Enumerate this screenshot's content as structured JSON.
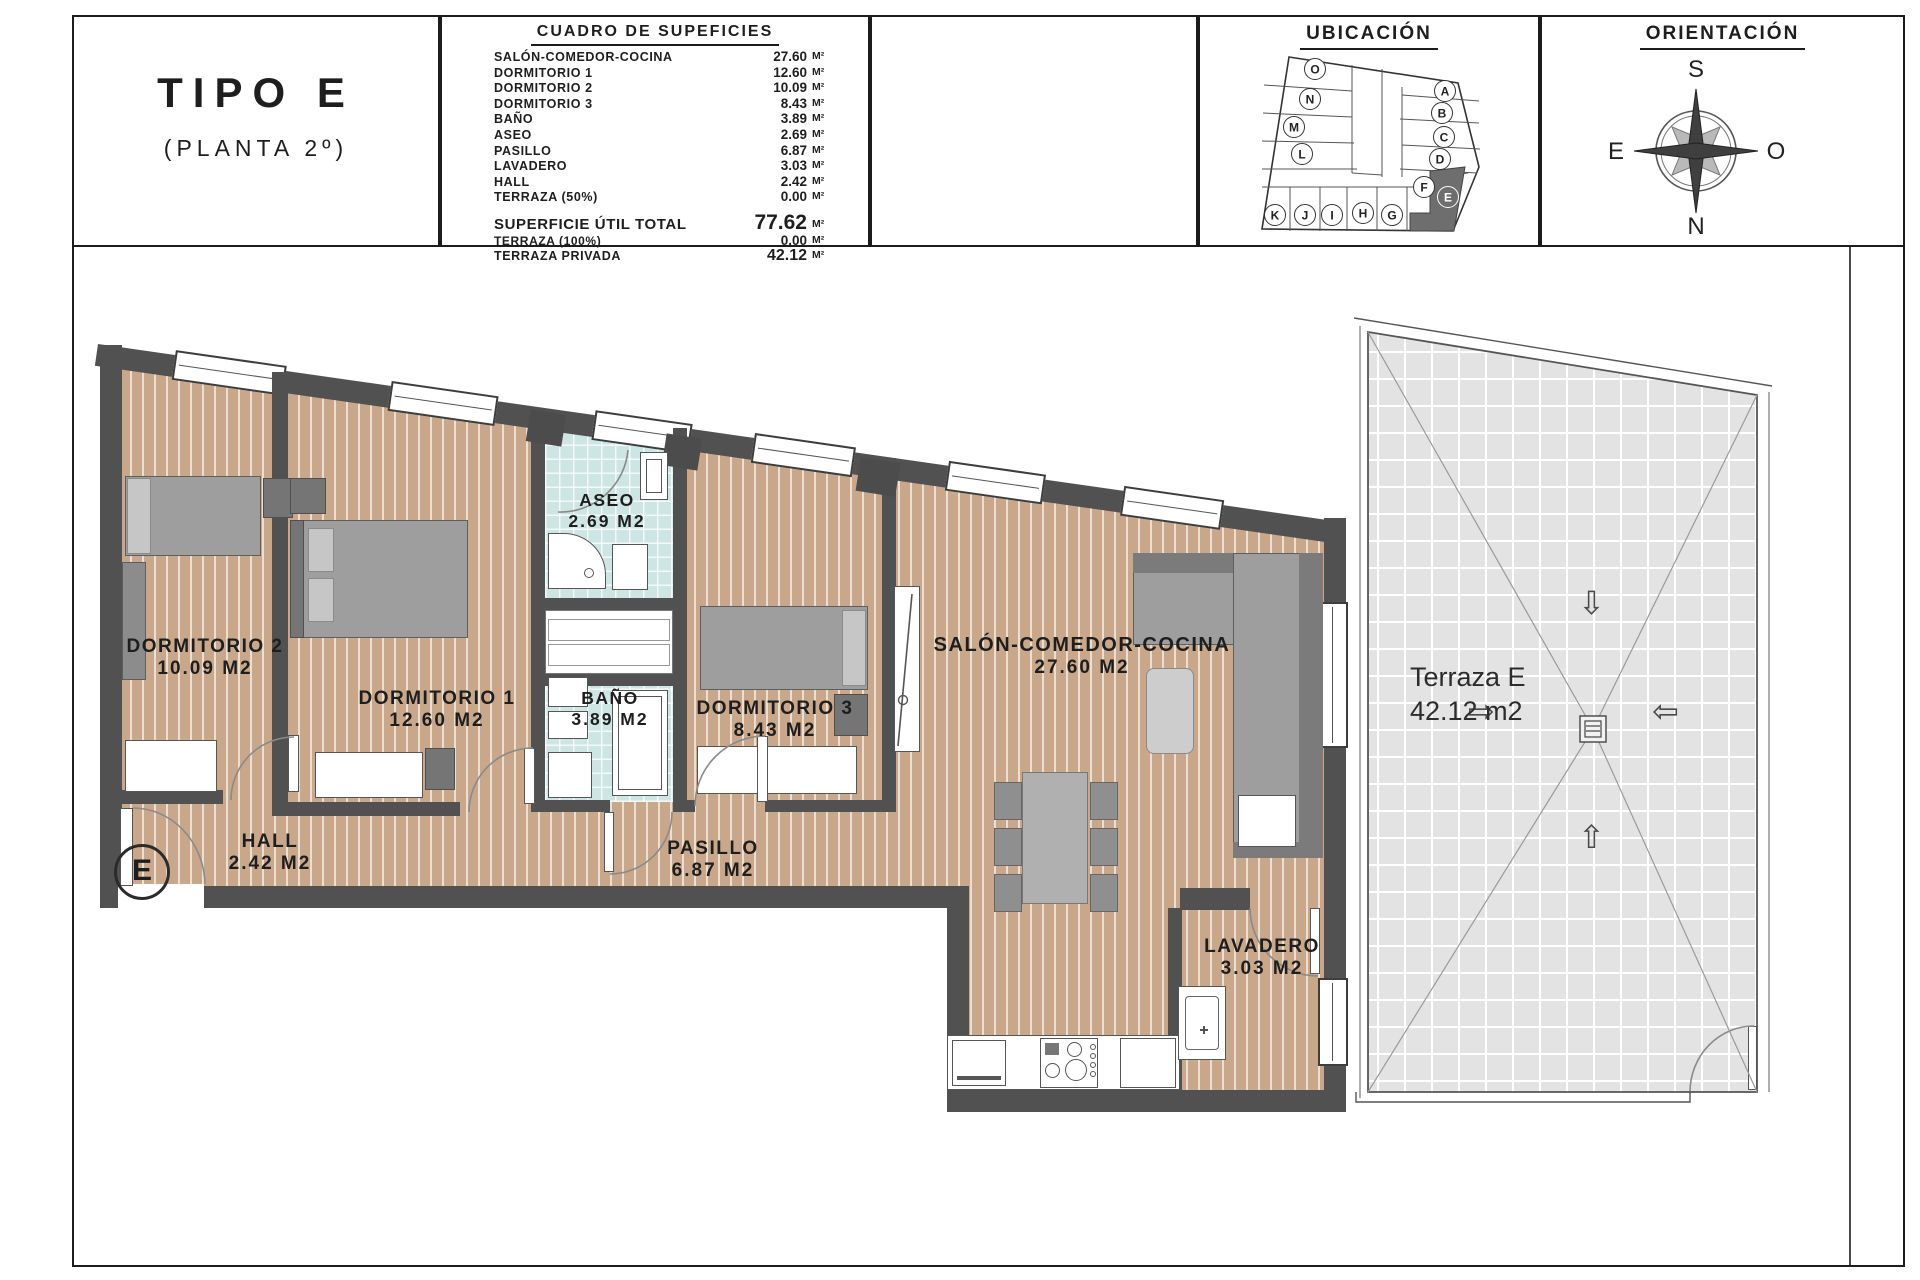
{
  "sheet": {
    "title_block": {
      "type": "TIPO E",
      "floor": "(PLANTA 2º)"
    },
    "surface_table": {
      "title": "CUADRO DE SUPEFICIES",
      "unit": "M²",
      "rows": [
        {
          "label": "SALÓN-COMEDOR-COCINA",
          "value": "27.60"
        },
        {
          "label": "DORMITORIO 1",
          "value": "12.60"
        },
        {
          "label": "DORMITORIO 2",
          "value": "10.09"
        },
        {
          "label": "DORMITORIO 3",
          "value": "8.43"
        },
        {
          "label": "BAÑO",
          "value": "3.89"
        },
        {
          "label": "ASEO",
          "value": "2.69"
        },
        {
          "label": "PASILLO",
          "value": "6.87"
        },
        {
          "label": "LAVADERO",
          "value": "3.03"
        },
        {
          "label": "HALL",
          "value": "2.42"
        },
        {
          "label": "TERRAZA (50%)",
          "value": "0.00"
        }
      ],
      "summary_rows": [
        {
          "label": "SUPERFICIE ÚTIL TOTAL",
          "value": "77.62"
        },
        {
          "label": "TERRAZA (100%)",
          "value": "0.00"
        },
        {
          "label": "TERRAZA PRIVADA",
          "value": "42.12"
        }
      ]
    },
    "ubicacion": {
      "title": "UBICACIÓN",
      "units": [
        "O",
        "N",
        "M",
        "L",
        "A",
        "B",
        "C",
        "D",
        "F",
        "E",
        "K",
        "J",
        "I",
        "H",
        "G"
      ],
      "highlighted_unit": "E"
    },
    "orientacion": {
      "title": "ORIENTACIÓN",
      "south": "S",
      "north": "N",
      "east": "E",
      "west": "O"
    }
  },
  "plan": {
    "rooms": [
      {
        "name": "DORMITORIO 2",
        "area": "10.09 M2"
      },
      {
        "name": "DORMITORIO 1",
        "area": "12.60 M2"
      },
      {
        "name": "ASEO",
        "area": "2.69 M2"
      },
      {
        "name": "BAÑO",
        "area": "3.89 M2"
      },
      {
        "name": "DORMITORIO 3",
        "area": "8.43 M2"
      },
      {
        "name": "SALÓN-COMEDOR-COCINA",
        "area": "27.60 M2"
      },
      {
        "name": "HALL",
        "area": "2.42 M2"
      },
      {
        "name": "PASILLO",
        "area": "6.87 M2"
      },
      {
        "name": "LAVADERO",
        "area": "3.03 M2"
      }
    ],
    "entrance_label": "E",
    "terrace": {
      "name": "Terraza E",
      "area": "42.12 m2"
    }
  },
  "colors": {
    "wall": "#515151",
    "wood_floor": "#c9a78b",
    "bath_tile": "#cde6e3",
    "terrace_tile": "#e3e3e3",
    "line": "#1c1c1c"
  }
}
